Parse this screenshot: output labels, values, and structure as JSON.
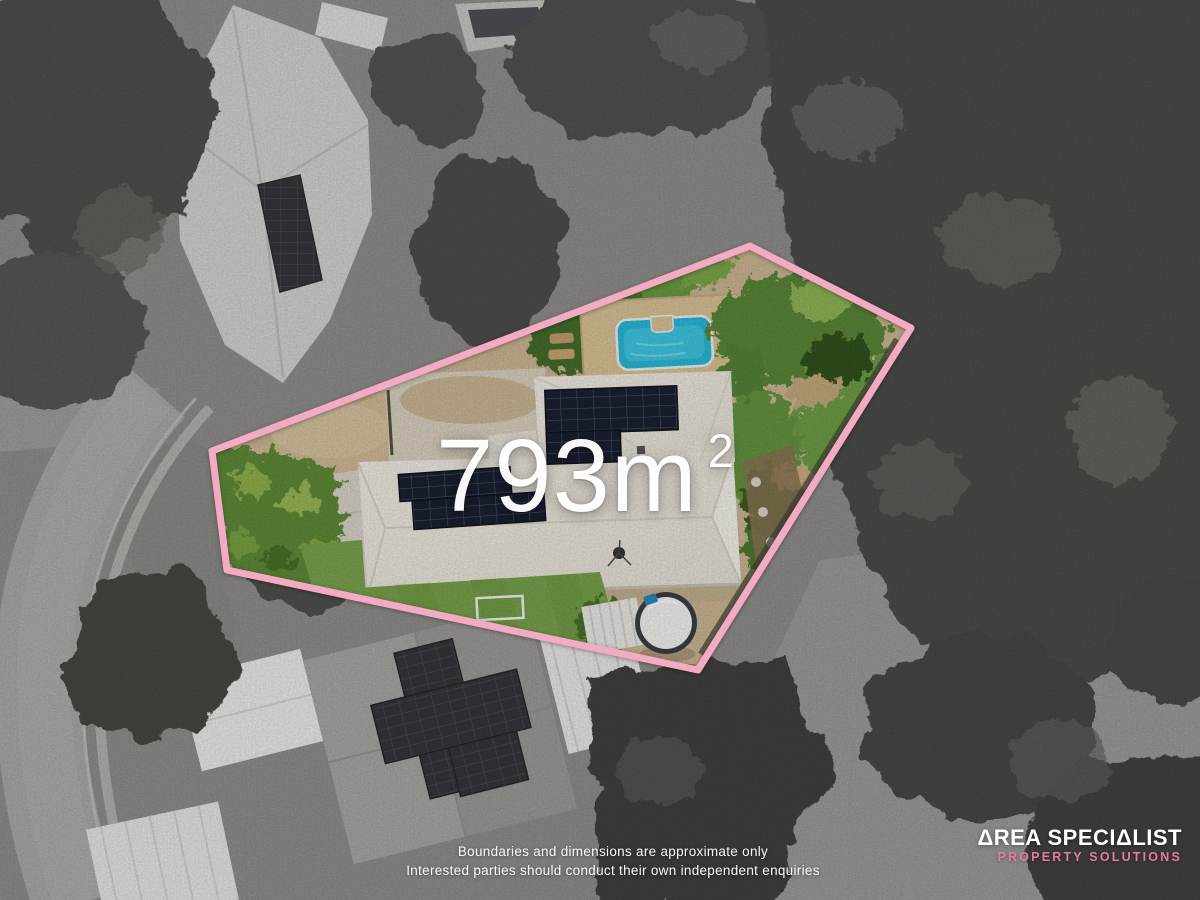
{
  "overlay": {
    "area_text": "793m",
    "area_exponent": "2"
  },
  "disclaimer": {
    "line1": "Boundaries and dimensions are approximate only",
    "line2": "Interested parties should conduct their own independent enquiries"
  },
  "brand": {
    "name": "ΔREA SPECIΔLIST",
    "tagline": "PROPERTY SOLUTIONS",
    "name_color": "#ffffff",
    "tagline_color": "#e57ba1"
  },
  "boundary": {
    "points": "750,246 911,328 698,670 227,570 212,451",
    "color": "#f3abc4",
    "stroke_width": 7
  },
  "palette": {
    "pool_water": "#2bb7d7",
    "pool_deck": "#d8c194",
    "house_roof": "#ece7de",
    "solar_panel": "#1b2030",
    "lawn": "#78a14b",
    "sand_ground": "#ccb593",
    "grayscale_base": "#8f8e8a"
  }
}
